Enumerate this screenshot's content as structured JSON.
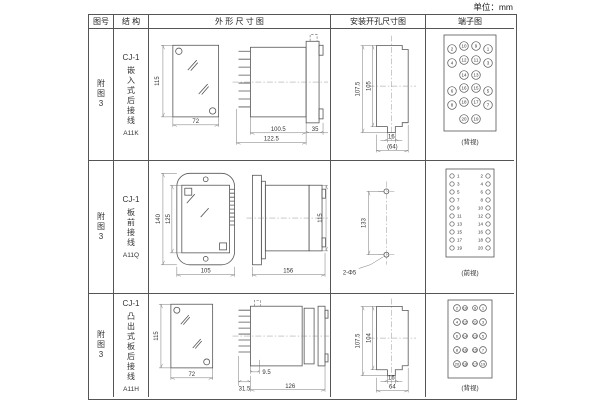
{
  "unit_label": "单位：mm",
  "header": {
    "fig_no": "图号",
    "structure": "结 构",
    "outline": "外 形 尺 寸 图",
    "mounting": "安装开孔尺寸图",
    "terminal": "端子图"
  },
  "rows": [
    {
      "fig": "附图3",
      "model": "CJ-1",
      "type": "嵌入式后接线",
      "code": "A11K",
      "outline": {
        "front_h": "115",
        "front_w": "72",
        "body_len": "100.5",
        "overall_len": "122.5",
        "flange_w": "35"
      },
      "mounting": {
        "outer_h": "107.5",
        "inner_h": "105",
        "tab_w": "16",
        "overall_w": "(64)"
      },
      "terminal": {
        "view": "(背视)",
        "rows": [
          [
            "2",
            "10",
            "9",
            "1"
          ],
          [
            "4",
            "12",
            "11",
            "3"
          ],
          [
            "14",
            "13"
          ],
          [
            "6",
            "16",
            "15",
            "5"
          ],
          [
            "8",
            "18",
            "17",
            "7"
          ],
          [
            "20",
            "19"
          ]
        ]
      }
    },
    {
      "fig": "附图3",
      "model": "CJ-1",
      "type": "板前接线",
      "code": "A11Q",
      "outline": {
        "front_h_outer": "140",
        "front_h_inner": "125",
        "front_w": "105",
        "side_len": "156",
        "side_h": "115"
      },
      "mounting": {
        "pitch": "133",
        "holes": "2-Φ5"
      },
      "terminal": {
        "view": "(前视)",
        "left": [
          "1",
          "3",
          "5",
          "7",
          "9",
          "11",
          "13",
          "15",
          "17",
          "19"
        ],
        "right": [
          "2",
          "4",
          "6",
          "8",
          "10",
          "12",
          "14",
          "16",
          "18",
          "20"
        ]
      }
    },
    {
      "fig": "附图3",
      "model": "CJ-1",
      "type": "凸出式板后接线",
      "code": "A11H",
      "outline": {
        "front_h": "115",
        "front_w": "72",
        "stud_len": "31.5",
        "offset": "9.5",
        "overall_len": "126"
      },
      "mounting": {
        "outer_h": "107.5",
        "inner_h": "104",
        "tab_w": "16",
        "overall_w": "64"
      },
      "terminal": {
        "view": "(背视)",
        "left_outer": [
          "2",
          "4",
          "6",
          "8",
          "20"
        ],
        "left_inner": [
          "10",
          "12",
          "14",
          "16",
          "18"
        ],
        "right_inner": [
          "9",
          "11",
          "13",
          "15",
          "17"
        ],
        "right_outer": [
          "1",
          "3",
          "5",
          "7",
          "19"
        ]
      }
    }
  ]
}
